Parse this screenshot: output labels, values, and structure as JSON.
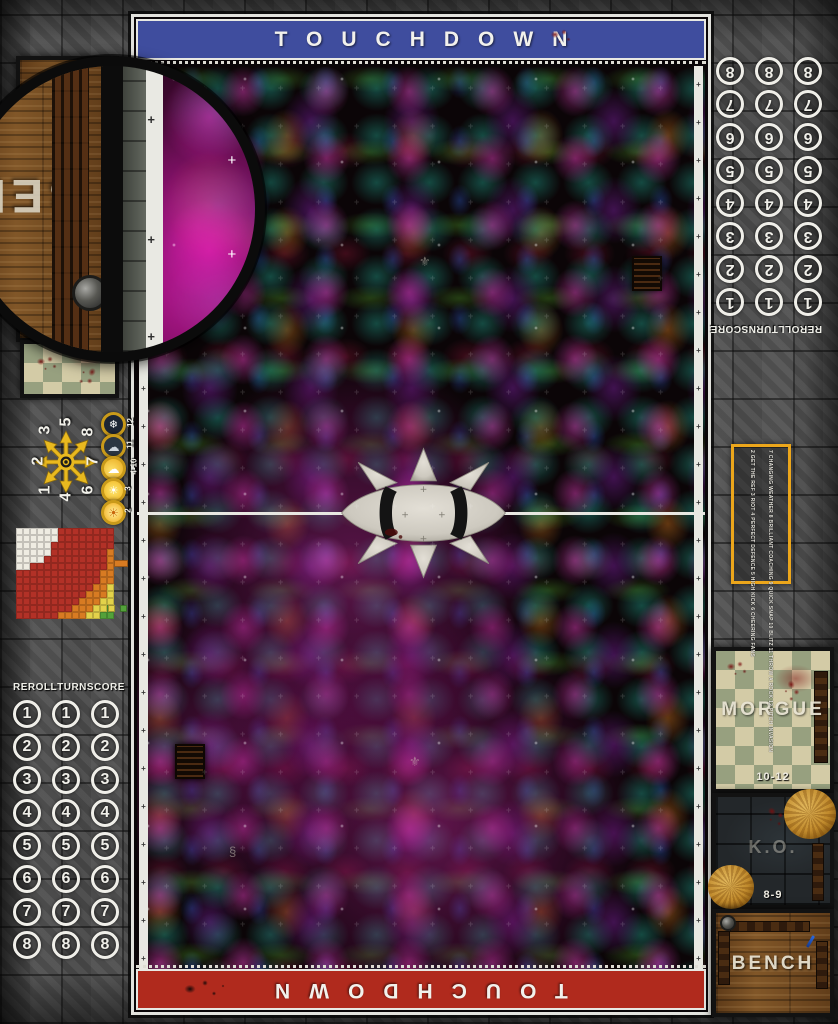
{
  "board": {
    "title_top_banner": "TOUCHDOWN",
    "title_bottom_banner": "TOUCHDOWN"
  },
  "tracks": {
    "headers": [
      "REROLL",
      "TURN",
      "SCORE"
    ],
    "rows": [
      "1",
      "2",
      "3",
      "4",
      "5",
      "6",
      "7",
      "8"
    ],
    "columns_per_row": 3
  },
  "dugouts": {
    "left": {
      "bench_label": "BENCH"
    },
    "right": {
      "morgue_label": "MORGUE",
      "morgue_range": "10-12",
      "ko_label": "K.O.",
      "ko_range": "8-9",
      "bench_label": "BENCH"
    }
  },
  "scatter_template": {
    "numbers": [
      {
        "n": "3",
        "x": 46,
        "y": 430
      },
      {
        "n": "5",
        "x": 67,
        "y": 422
      },
      {
        "n": "8",
        "x": 89,
        "y": 432
      },
      {
        "n": "2",
        "x": 39,
        "y": 461
      },
      {
        "n": "7",
        "x": 94,
        "y": 461
      },
      {
        "n": "1",
        "x": 46,
        "y": 490
      },
      {
        "n": "4",
        "x": 67,
        "y": 497
      },
      {
        "n": "6",
        "x": 89,
        "y": 490
      }
    ]
  },
  "weather_table": {
    "rows": [
      {
        "label": "12",
        "icon": "blizzard-icon",
        "glyph": "❄",
        "cls": "wx-blizzard"
      },
      {
        "label": "11",
        "icon": "rain-cloud-icon",
        "glyph": "☁",
        "cls": "wx-rain"
      },
      {
        "label": "4-10",
        "icon": "sun-and-cloud-icon",
        "glyph": "☁",
        "cls": "wx-cloudy"
      },
      {
        "label": "3",
        "icon": "sunny-icon",
        "glyph": "☀",
        "cls": "wx-sunny"
      },
      {
        "label": "2",
        "icon": "sweltering-sun-icon",
        "glyph": "☀",
        "cls": "wx-swelter"
      }
    ]
  },
  "kickoff_table": {
    "rows_right": [
      "2 GET THE REF",
      "3 RIOT",
      "4 PERFECT DEFENCE",
      "5 HIGH KICK",
      "6 CHEERING FANS"
    ],
    "rows_left": [
      "7 CHANGING WEATHER",
      "8 BRILLIANT COACHING",
      "9 QUICK SNAP",
      "10 BLITZ",
      "11 THROW A ROCK",
      "12 PITCH INVASION"
    ]
  },
  "chart_data": {
    "type": "heatmap",
    "title": "Pass range ruler",
    "cols": 14,
    "rows": 13,
    "legend": [
      {
        "band": "W",
        "color": "#efece2"
      },
      {
        "band": "R",
        "color": "#b23127"
      },
      {
        "band": "O",
        "color": "#d87b22"
      },
      {
        "band": "Y",
        "color": "#e3d24a"
      },
      {
        "band": "G",
        "color": "#53a13a"
      }
    ],
    "grid": [
      "WWWWWWRRRRRRRR",
      "WWWWWWRRRRRRRR",
      "WWWWWRRRRRRRRR",
      "WWWWWRRRRRRRRO",
      "WWWWRRRRRRRRRO",
      "WWRRRRRRRRRRRO",
      "RRRRRRRRRRRROO",
      "RRRRRRRRRRRROO",
      "RRRRRRRRRRROOY",
      "RRRRRRRRRROOOY",
      "RRRRRRRRROOOYY",
      "RRRRRRRROOOYYG",
      "RRRRRROOOOYYGG"
    ]
  },
  "colors": {
    "banner_top": "#3f4d9e",
    "banner_bottom": "#b02a1d",
    "accent_yellow": "#e9b91f",
    "kickoff_border": "#eca61b",
    "white_line": "#e8e8e2"
  }
}
